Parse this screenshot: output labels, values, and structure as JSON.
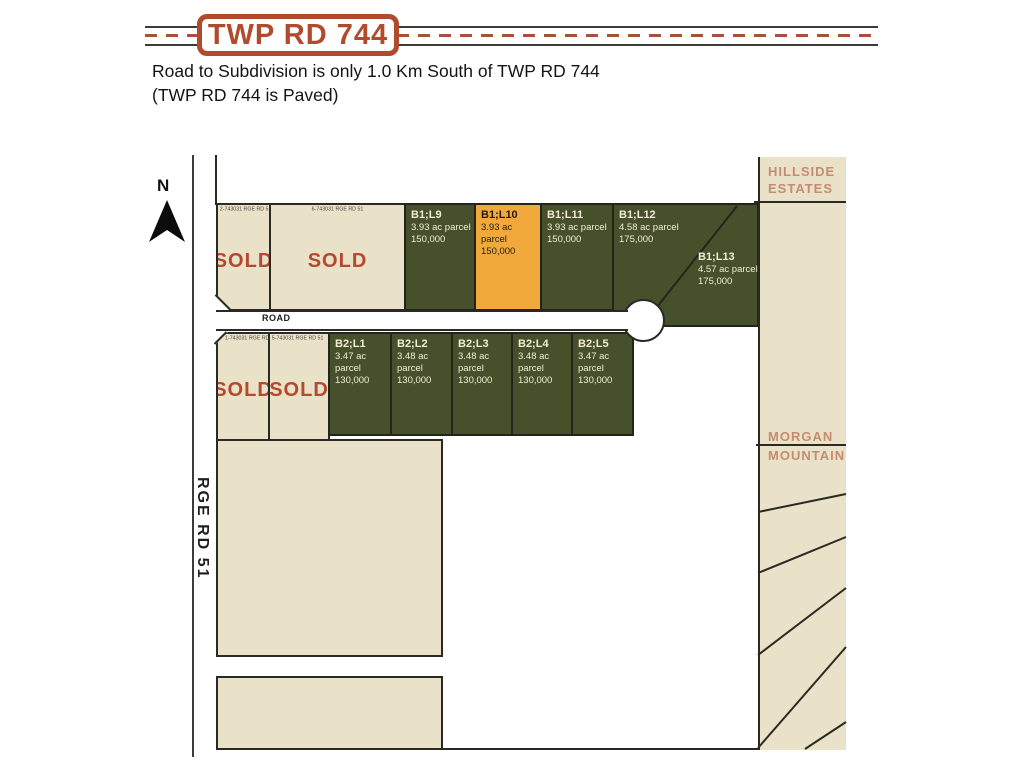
{
  "colors": {
    "badge_red": "#b04b2e",
    "sold_red": "#b3492d",
    "parcel_beige": "#e9e1c8",
    "lot_green": "#46502b",
    "lot_orange": "#f2a93c",
    "line_dark": "#2b2923",
    "neighbor_label_salmon": "#c68c72"
  },
  "header": {
    "road_badge": "TWP RD 744",
    "note_line1": "Road to Subdivision is only 1.0 Km South of TWP RD 744",
    "note_line2": "(TWP RD 744 is Paved)"
  },
  "map": {
    "north_label": "N",
    "rge_rd_label": "RGE RD 51",
    "road_label": "ROAD",
    "neighbors": {
      "hillside": {
        "line1": "HILLSIDE",
        "line2": "ESTATES"
      },
      "morgan": {
        "line1": "MORGAN",
        "line2": "MOUNTAIN"
      }
    },
    "sold_parcels": [
      {
        "id": "2-743031 RGE RD 51",
        "status": "SOLD"
      },
      {
        "id": "6-743031 RGE RD 51",
        "status": "SOLD"
      },
      {
        "id": "1-743031 RGE RD 51",
        "status": "SOLD"
      },
      {
        "id": "5-743031 RGE RD 51",
        "status": "SOLD"
      }
    ],
    "lots_row1": [
      {
        "id": "B1;L9",
        "size": "3.93 ac parcel",
        "price": "150,000",
        "highlighted": false
      },
      {
        "id": "B1;L10",
        "size": "3.93 ac parcel",
        "price": "150,000",
        "highlighted": true
      },
      {
        "id": "B1;L11",
        "size": "3.93 ac parcel",
        "price": "150,000",
        "highlighted": false
      },
      {
        "id": "B1;L12",
        "size": "4.58 ac parcel",
        "price": "175,000",
        "highlighted": false
      },
      {
        "id": "B1;L13",
        "size": "4.57 ac parcel",
        "price": "175,000",
        "highlighted": false
      }
    ],
    "lots_row2": [
      {
        "id": "B2;L1",
        "size": "3.47 ac parcel",
        "price": "130,000"
      },
      {
        "id": "B2;L2",
        "size": "3.48 ac parcel",
        "price": "130,000"
      },
      {
        "id": "B2;L3",
        "size": "3.48 ac parcel",
        "price": "130,000"
      },
      {
        "id": "B2;L4",
        "size": "3.48 ac parcel",
        "price": "130,000"
      },
      {
        "id": "B2;L5",
        "size": "3.47 ac parcel",
        "price": "130,000"
      }
    ]
  }
}
